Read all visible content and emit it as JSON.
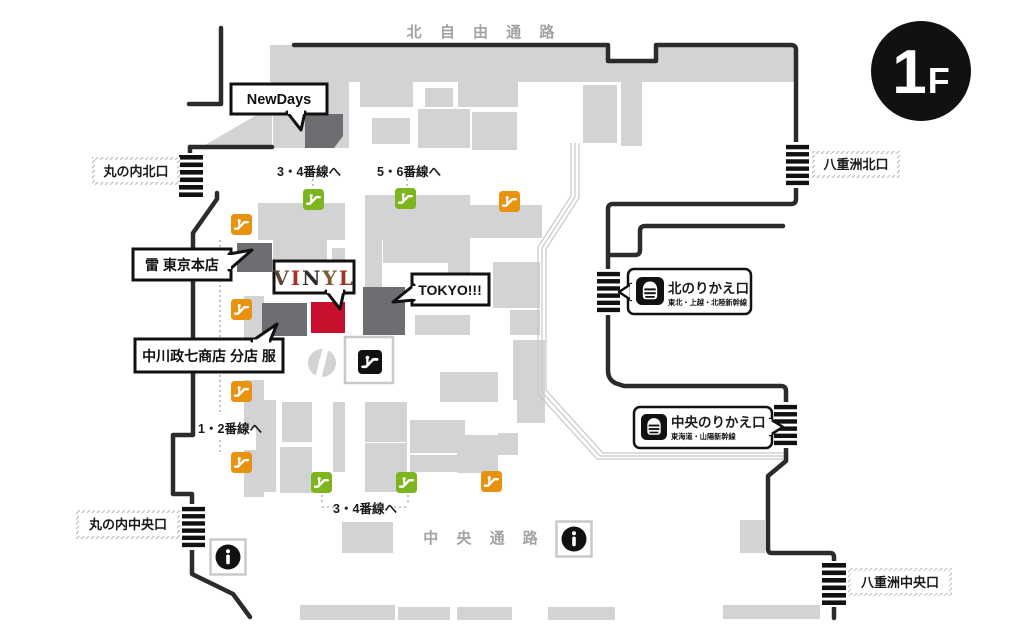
{
  "floor_badge": {
    "big": "1",
    "small": "F"
  },
  "corridors": {
    "north": "北 自 由 通 路",
    "central": "中 央 通 路"
  },
  "exits": {
    "marunouchi_north": "丸の内北口",
    "marunouchi_central": "丸の内中央口",
    "yaesu_north": "八重洲北口",
    "yaesu_central": "八重洲中央口"
  },
  "platform_links": {
    "p34_top": "3・4番線へ",
    "p56_top": "5・6番線へ",
    "p12": "1・2番線へ",
    "p34_bottom": "3・4番線へ"
  },
  "callouts": {
    "newdays": "NewDays",
    "kaminari": "雷 東京本店",
    "vinyl_letters": [
      "V",
      "I",
      "N",
      "Y",
      "L"
    ],
    "tokyo": "TOKYO!!!",
    "nakagawa": "中川政七商店 分店 服"
  },
  "transfer_gates": {
    "north": {
      "title": "北のりかえ口",
      "subtitle": "東北・上越・北陸新幹線"
    },
    "central": {
      "title": "中央のりかえ口",
      "subtitle": "東海道・山陽新幹線"
    }
  },
  "icons": {
    "escalator": "escalator-icon",
    "info": "information-icon",
    "gate": "ticket-gate-icon",
    "shinkansen": "shinkansen-icon"
  },
  "colors": {
    "block_gray": "#d2d3d4",
    "shop_dark": "#6d6e71",
    "shop_red": "#c8102e",
    "escalator_orange": "#e8920f",
    "escalator_green": "#7cb51e",
    "wall_black": "#2b2b2b",
    "corridor_text_gray": "#a2a2a2"
  }
}
